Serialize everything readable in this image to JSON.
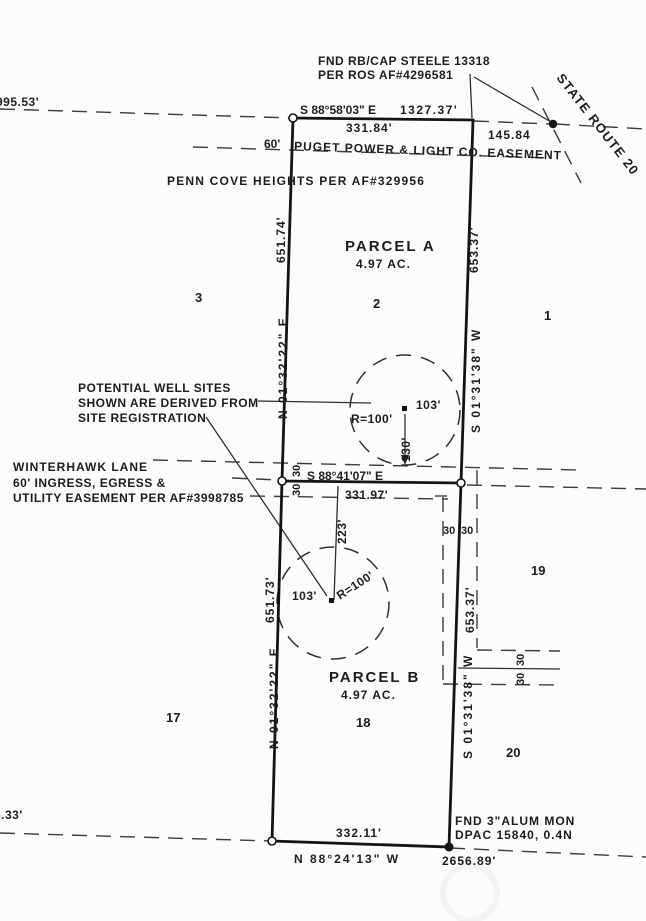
{
  "top": {
    "found_monument": [
      "FND RB/CAP STEELE 13318",
      "PER ROS AF#4296581"
    ],
    "route": "STATE ROUTE 20",
    "bearing": "S 88°58'03\" E",
    "distance": "1327.37'",
    "parcel_width": "331.84'",
    "corner_to_monument": "145.84",
    "easement_width": "60'",
    "easement": "PUGET POWER & LIGHT CO. EASEMENT",
    "subdivision": "PENN COVE HEIGHTS PER AF#329956",
    "left_distance": "995.53'"
  },
  "parcel_a": {
    "name": "PARCEL A",
    "area": "4.97 AC.",
    "west_bearing": "N 01°32'22\" E",
    "west_length": "651.74'",
    "east_bearing": "S 01°31'38\" W",
    "east_length": "653.37'",
    "well_radius": "R=100'",
    "well_offset": "103'",
    "well_to_lane": "130'"
  },
  "parcel_b": {
    "name": "PARCEL B",
    "area": "4.97 AC.",
    "west_bearing": "N 01°32'22\" E",
    "west_length": "651.73'",
    "east_bearing": "S 01°31'38\" W",
    "east_length": "653.37'",
    "well_radius": "R=100'",
    "well_offset": "103'",
    "well_to_lane": "223'"
  },
  "well_note": [
    "POTENTIAL WELL SITES",
    "SHOWN ARE DERIVED FROM",
    "SITE REGISTRATION"
  ],
  "lane": {
    "name": "WINTERHAWK LANE",
    "desc1": "60' INGRESS, EGRESS &",
    "desc2": "UTILITY EASEMENT PER AF#3998785",
    "bearing": "S 88°41'07\" E",
    "distance": "331.97'",
    "half_widths_west": [
      "30",
      "30"
    ],
    "half_widths_east": [
      "30",
      "30"
    ]
  },
  "east_easement": {
    "half_widths": [
      "30",
      "30"
    ]
  },
  "lots": {
    "l1": "1",
    "l2": "2",
    "l3": "3",
    "l17": "17",
    "l18": "18",
    "l19": "19",
    "l20": "20"
  },
  "bottom": {
    "parcel_width": "332.11'",
    "bearing": "N 88°24'13\" W",
    "distance": "2656.89'",
    "found_monument": [
      "FND 3\"ALUM MON",
      "DPAC 15840, 0.4N"
    ],
    "left_distance": "6.33'"
  }
}
